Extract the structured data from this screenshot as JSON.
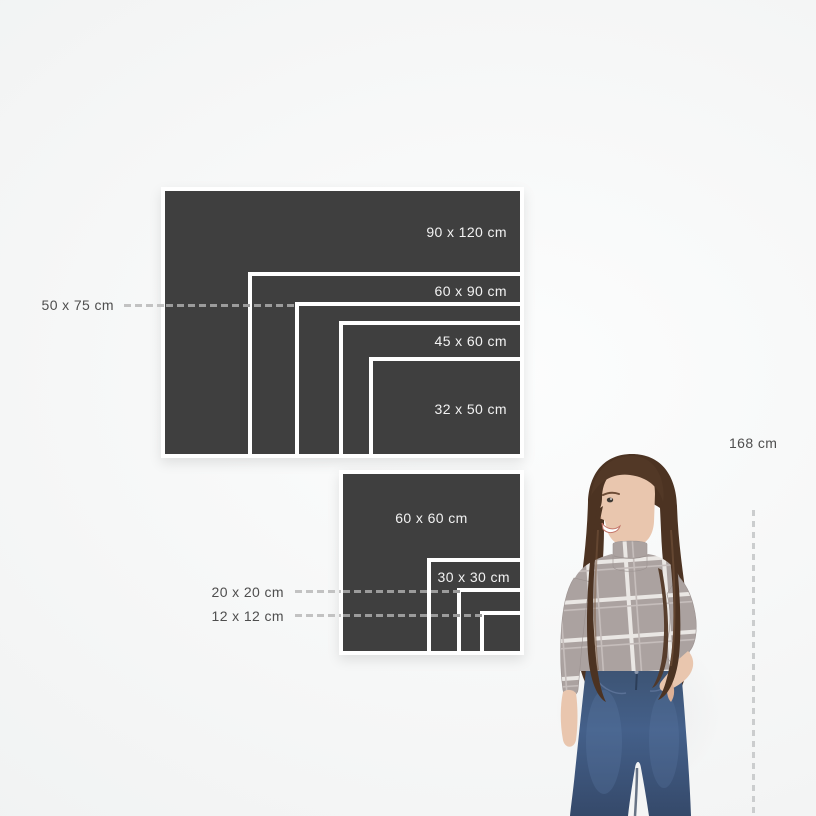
{
  "canvas": {
    "width_px": 816,
    "height_px": 816
  },
  "colors": {
    "background": "#f5f6f6",
    "panel": "#3f3f3f",
    "panel_border": "#ffffff",
    "label_on_panel": "#f2f2f2",
    "label_muted": "#4e4e4e",
    "callout_dash_light": "#c2c2c2",
    "callout_dash_on_panel": "#9c9c9c",
    "hair": "#4c3322",
    "skin": "#e9c6ae",
    "sweater": "#aba2a0",
    "sweater_check": "#eae7e4",
    "jeans": "#3e5472"
  },
  "size_chart": {
    "scale_px_per_cm": 2.95,
    "rect_group": {
      "panels": [
        {
          "id": "90x120",
          "label": "90 x 120 cm",
          "width_cm": 120,
          "height_cm": 90
        },
        {
          "id": "60x90",
          "label": "60 x 90 cm",
          "width_cm": 90,
          "height_cm": 60
        },
        {
          "id": "50x75",
          "label": "50 x 75 cm",
          "width_cm": 75,
          "height_cm": 50
        },
        {
          "id": "45x60",
          "label": "45 x 60 cm",
          "width_cm": 60,
          "height_cm": 45
        },
        {
          "id": "32x50",
          "label": "32 x 50 cm",
          "width_cm": 50,
          "height_cm": 32
        }
      ]
    },
    "square_group": {
      "panels": [
        {
          "id": "60x60",
          "label": "60 x 60 cm",
          "width_cm": 60,
          "height_cm": 60
        },
        {
          "id": "30x30",
          "label": "30 x 30 cm",
          "width_cm": 30,
          "height_cm": 30
        },
        {
          "id": "20x20",
          "label": "20 x 20 cm",
          "width_cm": 20,
          "height_cm": 20
        },
        {
          "id": "12x12",
          "label": "12 x 12 cm",
          "width_cm": 12,
          "height_cm": 12
        }
      ]
    }
  },
  "person": {
    "height_label": "168 cm",
    "height_cm": 168
  }
}
